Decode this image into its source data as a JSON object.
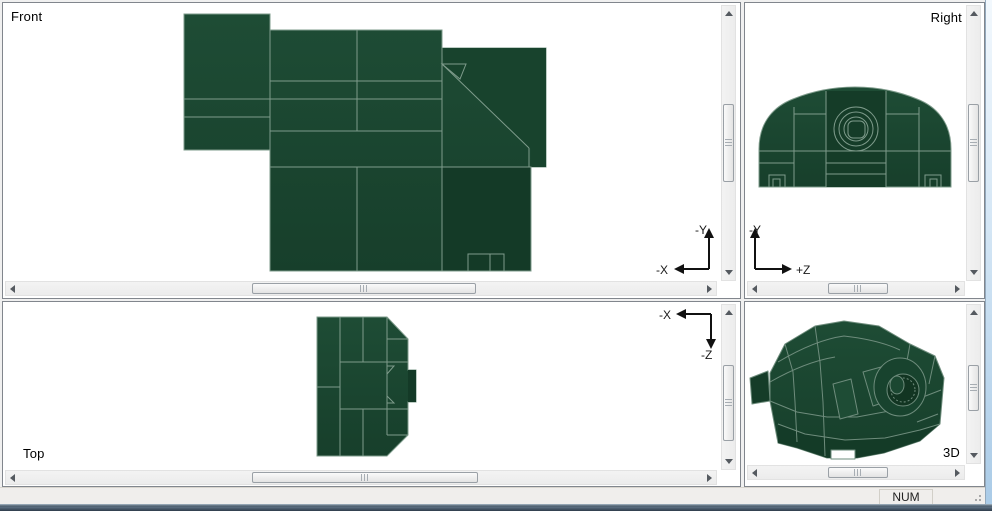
{
  "panes": {
    "front": {
      "label": "Front",
      "axis": {
        "up": "-Y",
        "left": "-X"
      }
    },
    "right": {
      "label": "Right",
      "axis": {
        "up": "-Y",
        "right": "+Z"
      }
    },
    "top": {
      "label": "Top",
      "axis": {
        "left": "-X",
        "down": "-Z"
      }
    },
    "threed": {
      "label": "3D"
    }
  },
  "status_bar": {
    "num_indicator": "NUM"
  },
  "colors": {
    "model_green": "#1B4731",
    "model_green_dark": "#153C28",
    "model_green_darker": "#123522",
    "model_edge_line": "#7E9B8B",
    "viewport_background": "#FFFFFF",
    "chrome_background": "#F0F0F0",
    "taskbar_strip": "#2F3B47",
    "aero_border": "#BDD8EE"
  }
}
